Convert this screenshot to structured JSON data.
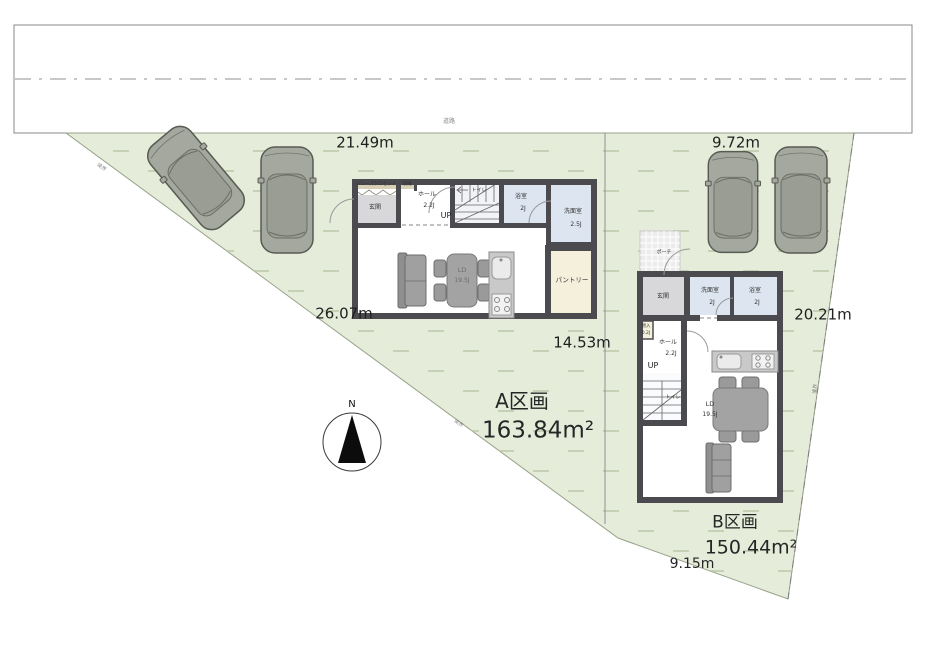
{
  "road": {
    "label": "道路"
  },
  "boundary": {
    "label": "境界"
  },
  "compass": {
    "north": "N"
  },
  "dimensions": {
    "a_top": "21.49m",
    "b_top": "9.72m",
    "a_left": "26.07m",
    "divider": "14.53m",
    "b_right": "20.21m",
    "b_bottom": "9.15m"
  },
  "plots": {
    "a": {
      "name": "A区画",
      "area": "163.84m²"
    },
    "b": {
      "name": "B区画",
      "area": "150.44m²"
    }
  },
  "plan_a": {
    "shoes_closet": "シューズクロゼット",
    "storage": "収納",
    "entrance": "玄関",
    "hall": "ホール",
    "hall_size": "2.2J",
    "up": "UP",
    "toilet": "トイレ",
    "bath": "浴室",
    "bath_size": "2J",
    "wash": "洗面室",
    "wash_size": "2.5J",
    "ld": "LD",
    "ld_size": "19.5J",
    "pantry": "パントリー"
  },
  "plan_b": {
    "porch": "ポーチ",
    "entrance": "玄関",
    "wash": "洗面室",
    "wash_size": "2J",
    "bath": "浴室",
    "bath_size": "2J",
    "closet": "物入",
    "closet_size": "0.2J",
    "hall": "ホール",
    "hall_size": "2.2J",
    "up": "UP",
    "toilet": "トイレ",
    "ld": "LD",
    "ld_size": "19.5J"
  },
  "colors": {
    "site_green": "#e5edda",
    "grass_dash": "#bdc9aa",
    "wall": "#4b4b4f",
    "wet_room_blue": "#dde6f0",
    "pantry_beige": "#f5f0dc",
    "entrance_gray": "#d8d8da",
    "furniture_gray": "#9c9c9c",
    "car_body": "#a5a89f"
  }
}
